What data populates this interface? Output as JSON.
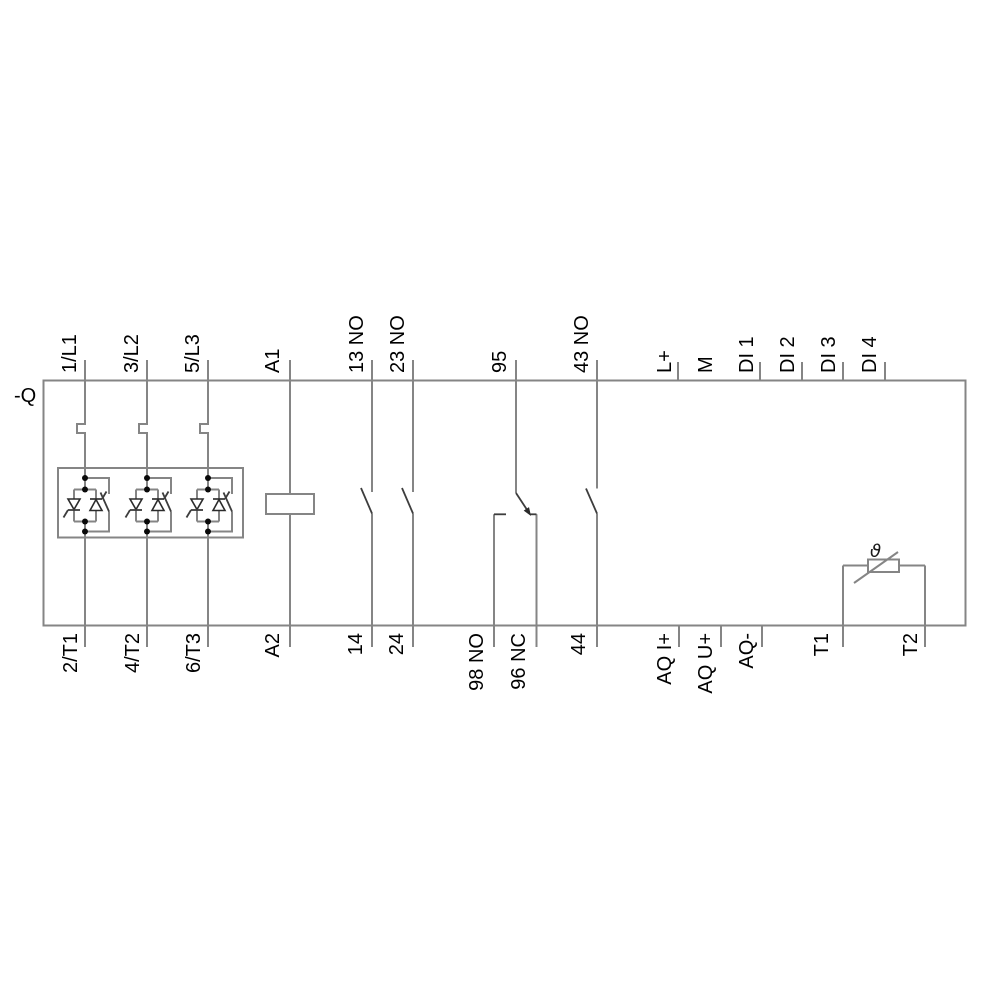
{
  "diagram": {
    "device_label": "-Q",
    "thermistor_symbol": "ϑ",
    "top_terminals": [
      "1/L1",
      "3/L2",
      "5/L3",
      "A1",
      "13 NO",
      "23 NO",
      "95",
      "43 NO",
      "L+",
      "M",
      "DI 1",
      "DI 2",
      "DI 3",
      "DI 4"
    ],
    "bottom_terminals": [
      "2/T1",
      "4/T2",
      "6/T3",
      "A2",
      "14",
      "24",
      "98 NO",
      "96 NC",
      "44",
      "AQ I+",
      "AQ U+",
      "AQ-",
      "T1",
      "T2"
    ]
  },
  "colors": {
    "background": "#ffffff",
    "wire": "#858585",
    "symbol": "#3d3d3d",
    "text": "#000000"
  }
}
